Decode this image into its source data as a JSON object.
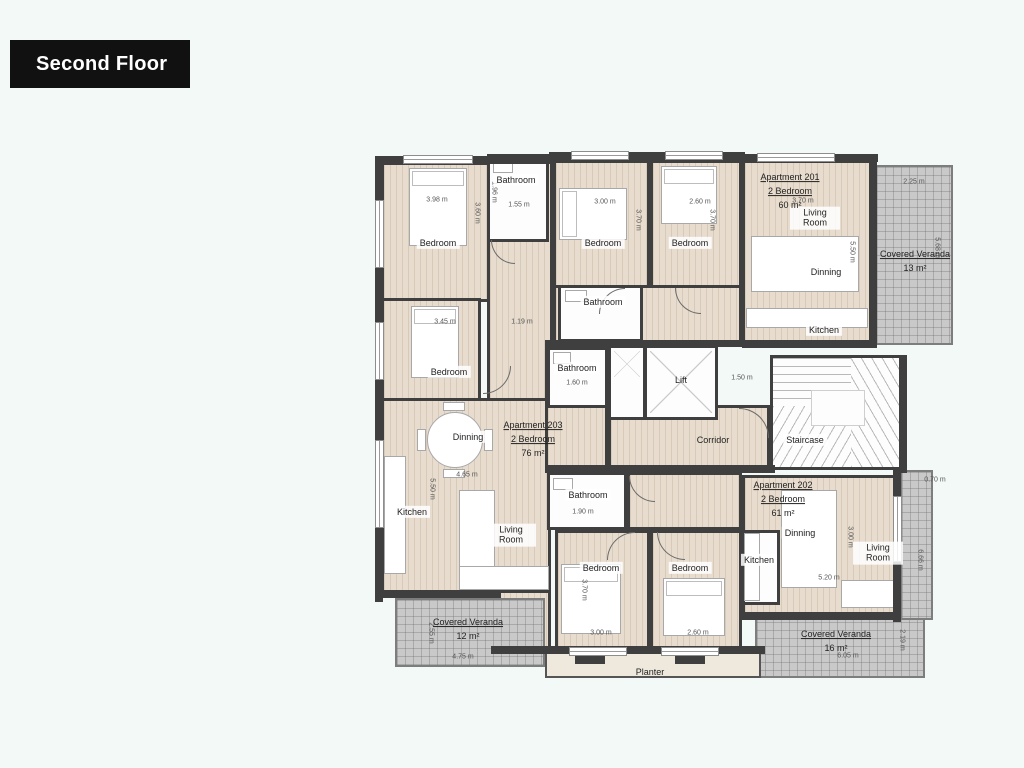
{
  "page": {
    "floor_label": "Second Floor",
    "colors": {
      "wall": "#3f3f3f",
      "floor": "#e7dccd",
      "veranda": "#c9c9c9",
      "badge": "#111111",
      "background": "#f3f9f7"
    }
  },
  "apartments": [
    {
      "name": "Apartment 201",
      "type": "2 Bedroom",
      "area": "60 m²",
      "rooms": {
        "bedroom1": "Bedroom",
        "bedroom2": "Bedroom",
        "bathroom": "Bathroom",
        "living": "Living Room",
        "dining": "Dinning",
        "kitchen": "Kitchen"
      }
    },
    {
      "name": "Apartment 202",
      "type": "2 Bedroom",
      "area": "61 m²",
      "rooms": {
        "bedroom1": "Bedroom",
        "bedroom2": "Bedroom",
        "bathroom": "Bathroom",
        "living": "Living Room",
        "dining": "Dinning",
        "kitchen": "Kitchen"
      }
    },
    {
      "name": "Apartment 203",
      "type": "2 Bedroom",
      "area": "76 m²",
      "rooms": {
        "bedroom1": "Bedroom",
        "bedroom2": "Bedroom",
        "bathroom1": "Bathroom",
        "bathroom2": "Bathroom",
        "living": "Living Room",
        "dining": "Dinning",
        "kitchen": "Kitchen"
      }
    }
  ],
  "common": {
    "lift": "Lift",
    "corridor": "Corridor",
    "staircase": "Staircase",
    "planter": "Planter"
  },
  "verandas": [
    {
      "label": "Covered Veranda",
      "area": "13 m²"
    },
    {
      "label": "Covered Veranda",
      "area": "12 m²"
    },
    {
      "label": "Covered Veranda",
      "area": "16 m²"
    }
  ],
  "dims": {
    "a203_bed1_w": "3.98 m",
    "a203_bed1_h": "3.60 m",
    "a203_bath1_h": "1.96 m",
    "a203_bath1_w": "1.55 m",
    "a203_bed2_w": "3.45 m",
    "a203_hall_w": "1.19 m",
    "a203_dining_w": "4.65 m",
    "a203_living_h": "5.50 m",
    "a203_bath2_w": "1.60 m",
    "a201_bed1_w": "3.00 m",
    "a201_bed2_w": "2.60 m",
    "a201_bed1_h": "3.70 m",
    "a201_bed2_h": "3.70 m",
    "a201_living_w": "3.70 m",
    "a201_living_h": "5.50 m",
    "corridor_w": "1.50 m",
    "ver13_w": "2.25 m",
    "ver13_h": "5.68 m",
    "a202_bath_w": "1.90 m",
    "a202_bed1_w": "3.00 m",
    "a202_bed2_w": "2.60 m",
    "a202_bed1_h": "3.70 m",
    "a202_dining_w": "5.20 m",
    "a202_living_h": "3.00 m",
    "strip_w": "0.70 m",
    "strip_h": "6.66 m",
    "ver12_w": "4.75 m",
    "ver12_h": "2.55 m",
    "ver16_w": "6.05 m",
    "ver16_h": "2.19 m"
  }
}
